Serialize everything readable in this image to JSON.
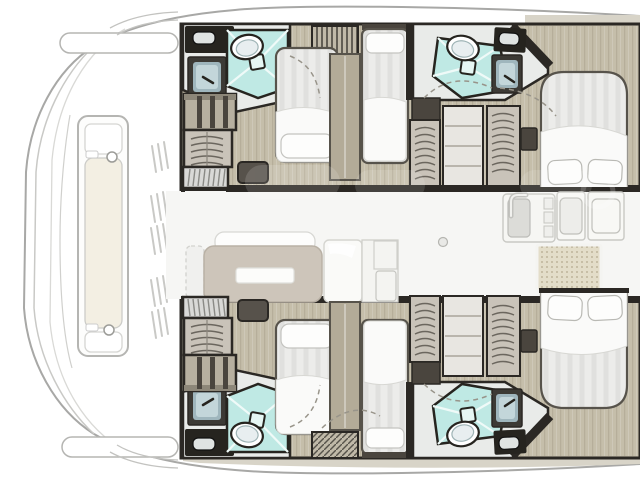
{
  "colors": {
    "bg": "#ffffff",
    "hull_line": "#a8a8a6",
    "hull_line_light": "#c9c9c6",
    "wall": "#2b2824",
    "furn_line": "#57534b",
    "floor": "#c5beaa",
    "room_floor": "#e9ebe9",
    "shower": "#bfe9e4",
    "shower_line": "#effaf8",
    "drain": "#e6f6f3",
    "white_fixture": "#f9f9f7",
    "mattress": "#ececea",
    "duvet": "#fafaf9",
    "pillow": "#fdfdfc",
    "cabinet_dark": "#26241f",
    "cabinet_mid": "#4a453e",
    "divider": "#b3ab98",
    "wardrobe": "#b7b0a0",
    "wardrobe_top": "#8d8779",
    "locker": "#c9c3b9",
    "sofa": "#cdc5ba",
    "sofa_back": "#fdfdfc",
    "metal_dark": "#3c3a35",
    "metal": "#9fb6bd",
    "metal_light": "#c3d6da",
    "mat": "#e3ddc9",
    "mat_dot": "#b3a98e",
    "deck_strip": "#d8d4c8",
    "stairs": "#d9d9d7",
    "stair_line": "#8a8a86",
    "arc": "#98948a",
    "shelf_line": "#b9b5ac"
  },
  "diagram": {
    "type": "floor-plan",
    "subject": "catamaran interior layout, top view",
    "orientation": "bow-left, stern cropped at right edge",
    "foredeck": {
      "features": [
        "sunpad-lounge",
        "cleats",
        "deck-vents",
        "bow-steps"
      ]
    },
    "salon": {
      "features": [
        "sofa",
        "sofa-table",
        "bench-outline",
        "fridge-cabinet",
        "galley-counter",
        "cooktop",
        "sink",
        "faucet",
        "floor-mat"
      ]
    },
    "port_hull": {
      "features": [
        "forward-head (shower, toilet, vanity, sink)",
        "shelved-wardrobe",
        "hanging-locker",
        "stairs",
        "step-pouf",
        "forward-double-bed",
        "single-berth",
        "mid-head (shower, toilet, vanity, sink)",
        "hanging-lockers",
        "shelf-column",
        "aft-island-double-bed",
        "nightstand"
      ]
    },
    "starboard_hull": {
      "features": [
        "forward-head (shower, toilet, vanity, sink)",
        "shelved-wardrobe",
        "hanging-locker",
        "stairs",
        "step-pouf",
        "forward-double-bed",
        "single-berth",
        "mid-head (shower, toilet, vanity, sink)",
        "hanging-lockers",
        "shelf-column",
        "aft-island-double-bed",
        "nightstand"
      ]
    },
    "counts": {
      "cabins": 4,
      "heads": 4,
      "berths_visible": 6
    }
  }
}
